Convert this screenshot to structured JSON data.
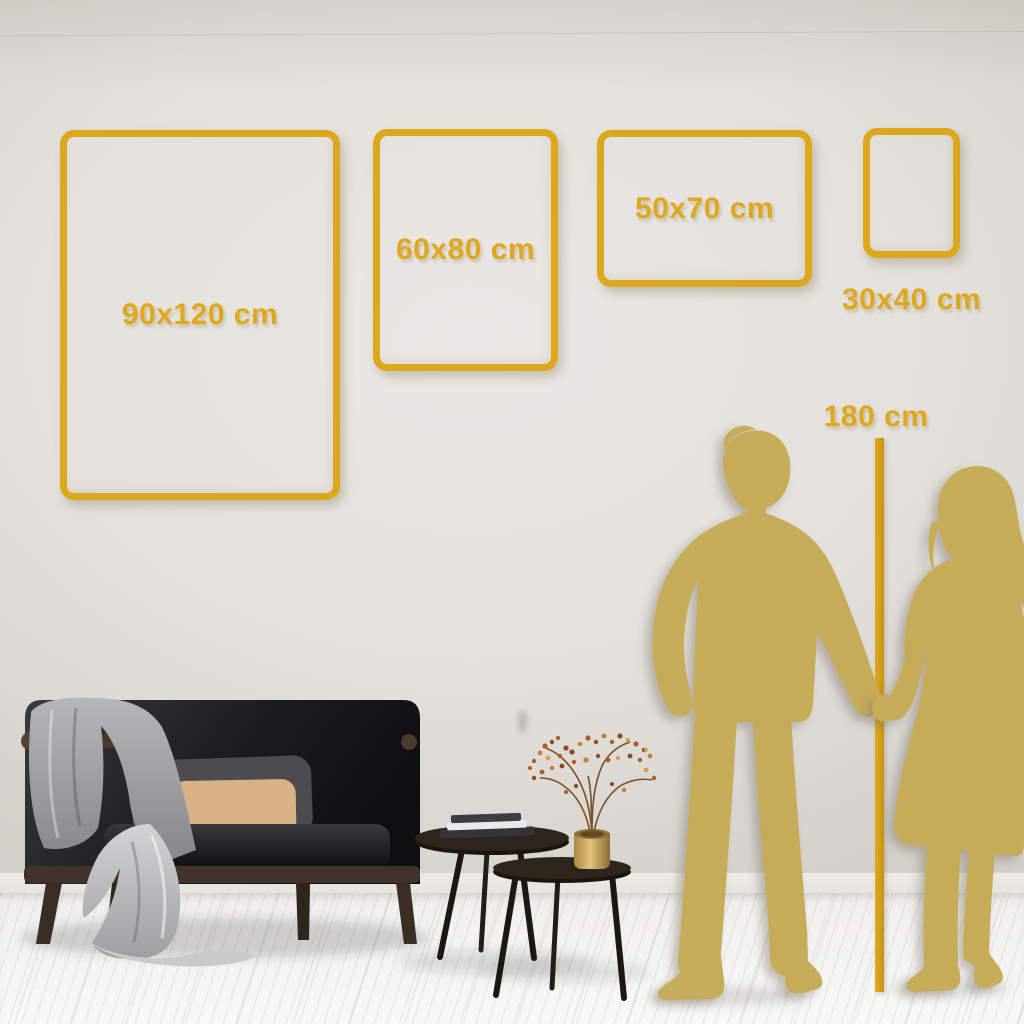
{
  "size_guide": {
    "unit": "cm",
    "frames": [
      {
        "label": "90x120 cm",
        "width_cm": 90,
        "height_cm": 120
      },
      {
        "label": "60x80 cm",
        "width_cm": 60,
        "height_cm": 80
      },
      {
        "label": "50x70 cm",
        "width_cm": 50,
        "height_cm": 70
      },
      {
        "label": "30x40 cm",
        "width_cm": 30,
        "height_cm": 40
      }
    ],
    "height_marker": {
      "label": "180 cm",
      "height_cm": 180
    }
  },
  "colors": {
    "accent_gold": "#DCA61D",
    "silhouette_gold": "#C6AC58",
    "wall": "#E2DFDA",
    "floor": "#F5F4F2"
  },
  "scene": {
    "objects": [
      "sofa",
      "throw-blanket",
      "gray-pillow",
      "tan-pillow",
      "floor-drape",
      "coffee-table-large",
      "coffee-table-small",
      "books",
      "vase",
      "dried-plant",
      "man-silhouette",
      "woman-silhouette",
      "height-ruler"
    ]
  }
}
